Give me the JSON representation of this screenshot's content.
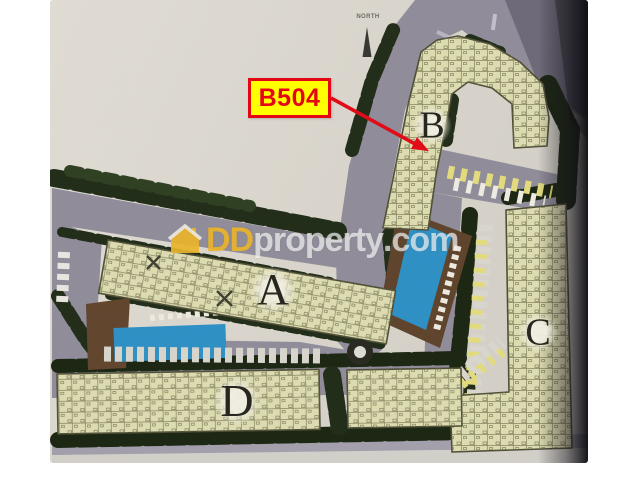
{
  "photo": {
    "type": "condominium-site-plan-photo",
    "paper_color": "#dad6cd"
  },
  "annotations": {
    "unit_callout": {
      "label": "B504",
      "box_fill": "#ffff00",
      "box_border": "#e30613",
      "text_color": "#e30613",
      "arrow_color": "#e30613"
    },
    "north": {
      "label": "NORTH"
    }
  },
  "buildings": {
    "a": {
      "label": "A"
    },
    "b": {
      "label": "B"
    },
    "c": {
      "label": "C"
    },
    "d": {
      "label": "D"
    },
    "fill_color": "#dedcb0"
  },
  "site": {
    "colors": {
      "road": "#8f8b99",
      "trees_dark": "#18230f",
      "trees": "#1e2a15",
      "pool": "#2b8fc4",
      "deck_brown": "#5d4129",
      "parking_car_yellow": "#e3dc7c",
      "parking_car_white": "#d9d6ce"
    }
  },
  "watermark": {
    "icon": "house-icon",
    "part1": "DD",
    "part2": "property",
    "part3": ".com",
    "part1_color": "#ecb429",
    "text_color": "#ffffff"
  }
}
